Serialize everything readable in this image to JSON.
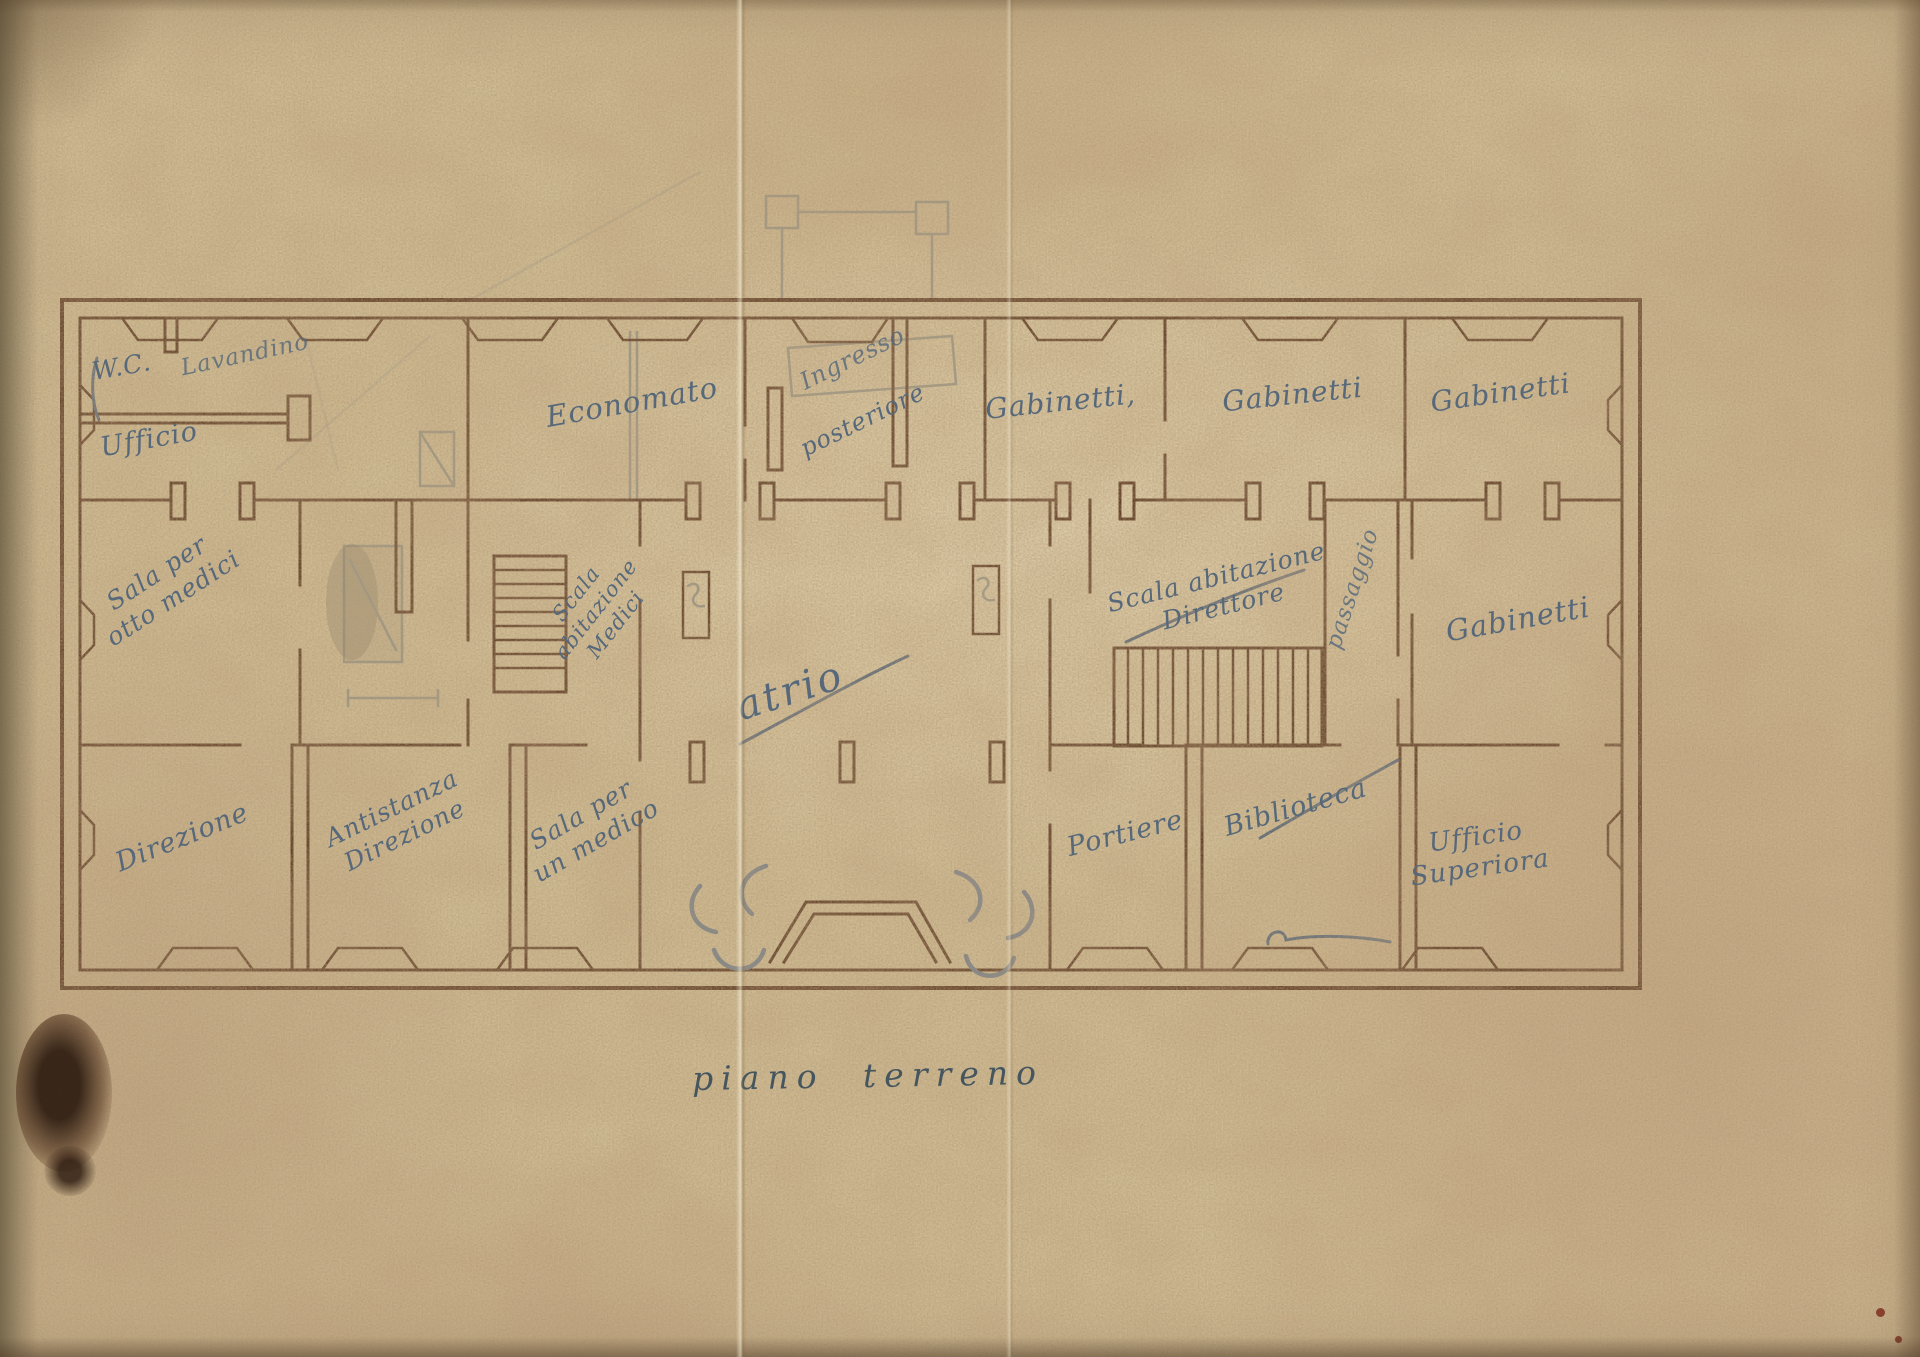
{
  "title": {
    "text": "piano terreno"
  },
  "labels": {
    "wc": "W.C.",
    "lavandino": "Lavandino",
    "ufficio": "Ufficio",
    "sala_otto_medici": "Sala per\notto medici",
    "economato": "Economato",
    "ingresso": "Ingresso",
    "posteriore": "posteriore",
    "gabinetti_1": "Gabinetti,",
    "gabinetti_2": "Gabinetti",
    "gabinetti_3": "Gabinetti",
    "scala_abitazione_medici": "Scala\nabitazione\nMedici",
    "atrio": "atrio",
    "scala_abitazione_direttore": "Scala abitazione\nDirettore",
    "passaggio": "passaggio",
    "gabinetti_4": "Gabinetti",
    "direzione": "Direzione",
    "antistanza_direzione": "Antistanza\nDirezione",
    "sala_un_medico": "Sala per\nun medico",
    "portiere": "Portiere",
    "biblioteca": "Biblioteca",
    "ufficio_superiora": "Ufficio\nSuperiora"
  },
  "colors": {
    "paper": "#d2c096",
    "ink": "#5a3820",
    "hand": "#56687a",
    "pencil": "#8b8e84",
    "title_ink": "#46565f"
  }
}
